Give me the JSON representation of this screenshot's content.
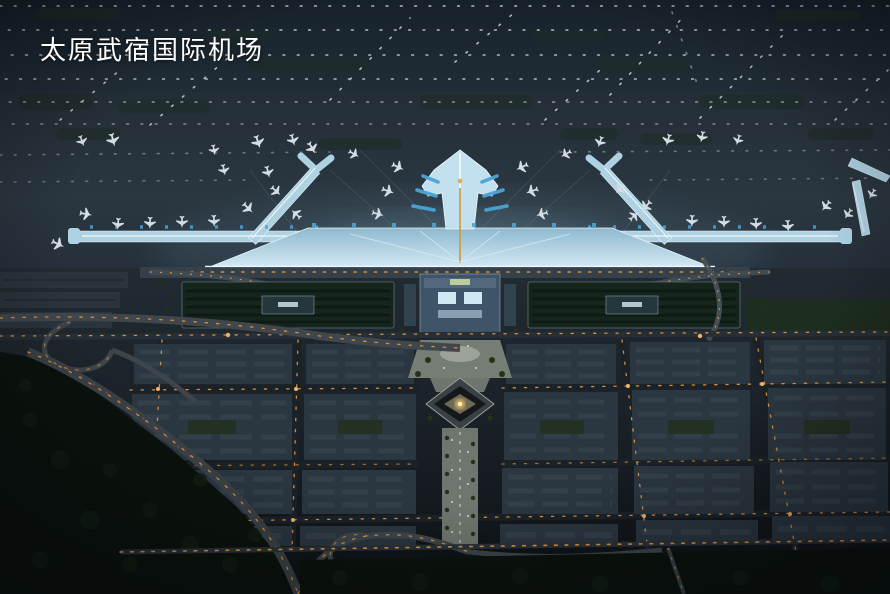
{
  "caption": {
    "title": "太原武宿国际机场"
  },
  "colors": {
    "sky-dark": "#18232c",
    "airfield": "#202b34",
    "apron": "#27333b",
    "terminal-glow": "#eaf6fc",
    "terminal-roof": "#b7d6e4",
    "pier": "#aed2e2",
    "jetbridge-blue": "#4aa3d6",
    "gold-spine": "#c9a04a",
    "street-orange": "#dd9440",
    "plaza-gray": "#767d75",
    "city-block": "#2a3640",
    "city-roof": "#33404a",
    "parking-green": "#15251b",
    "forest": "#0b120d",
    "light-dot": "#d7dee2",
    "caption-text": "#ffffff"
  }
}
